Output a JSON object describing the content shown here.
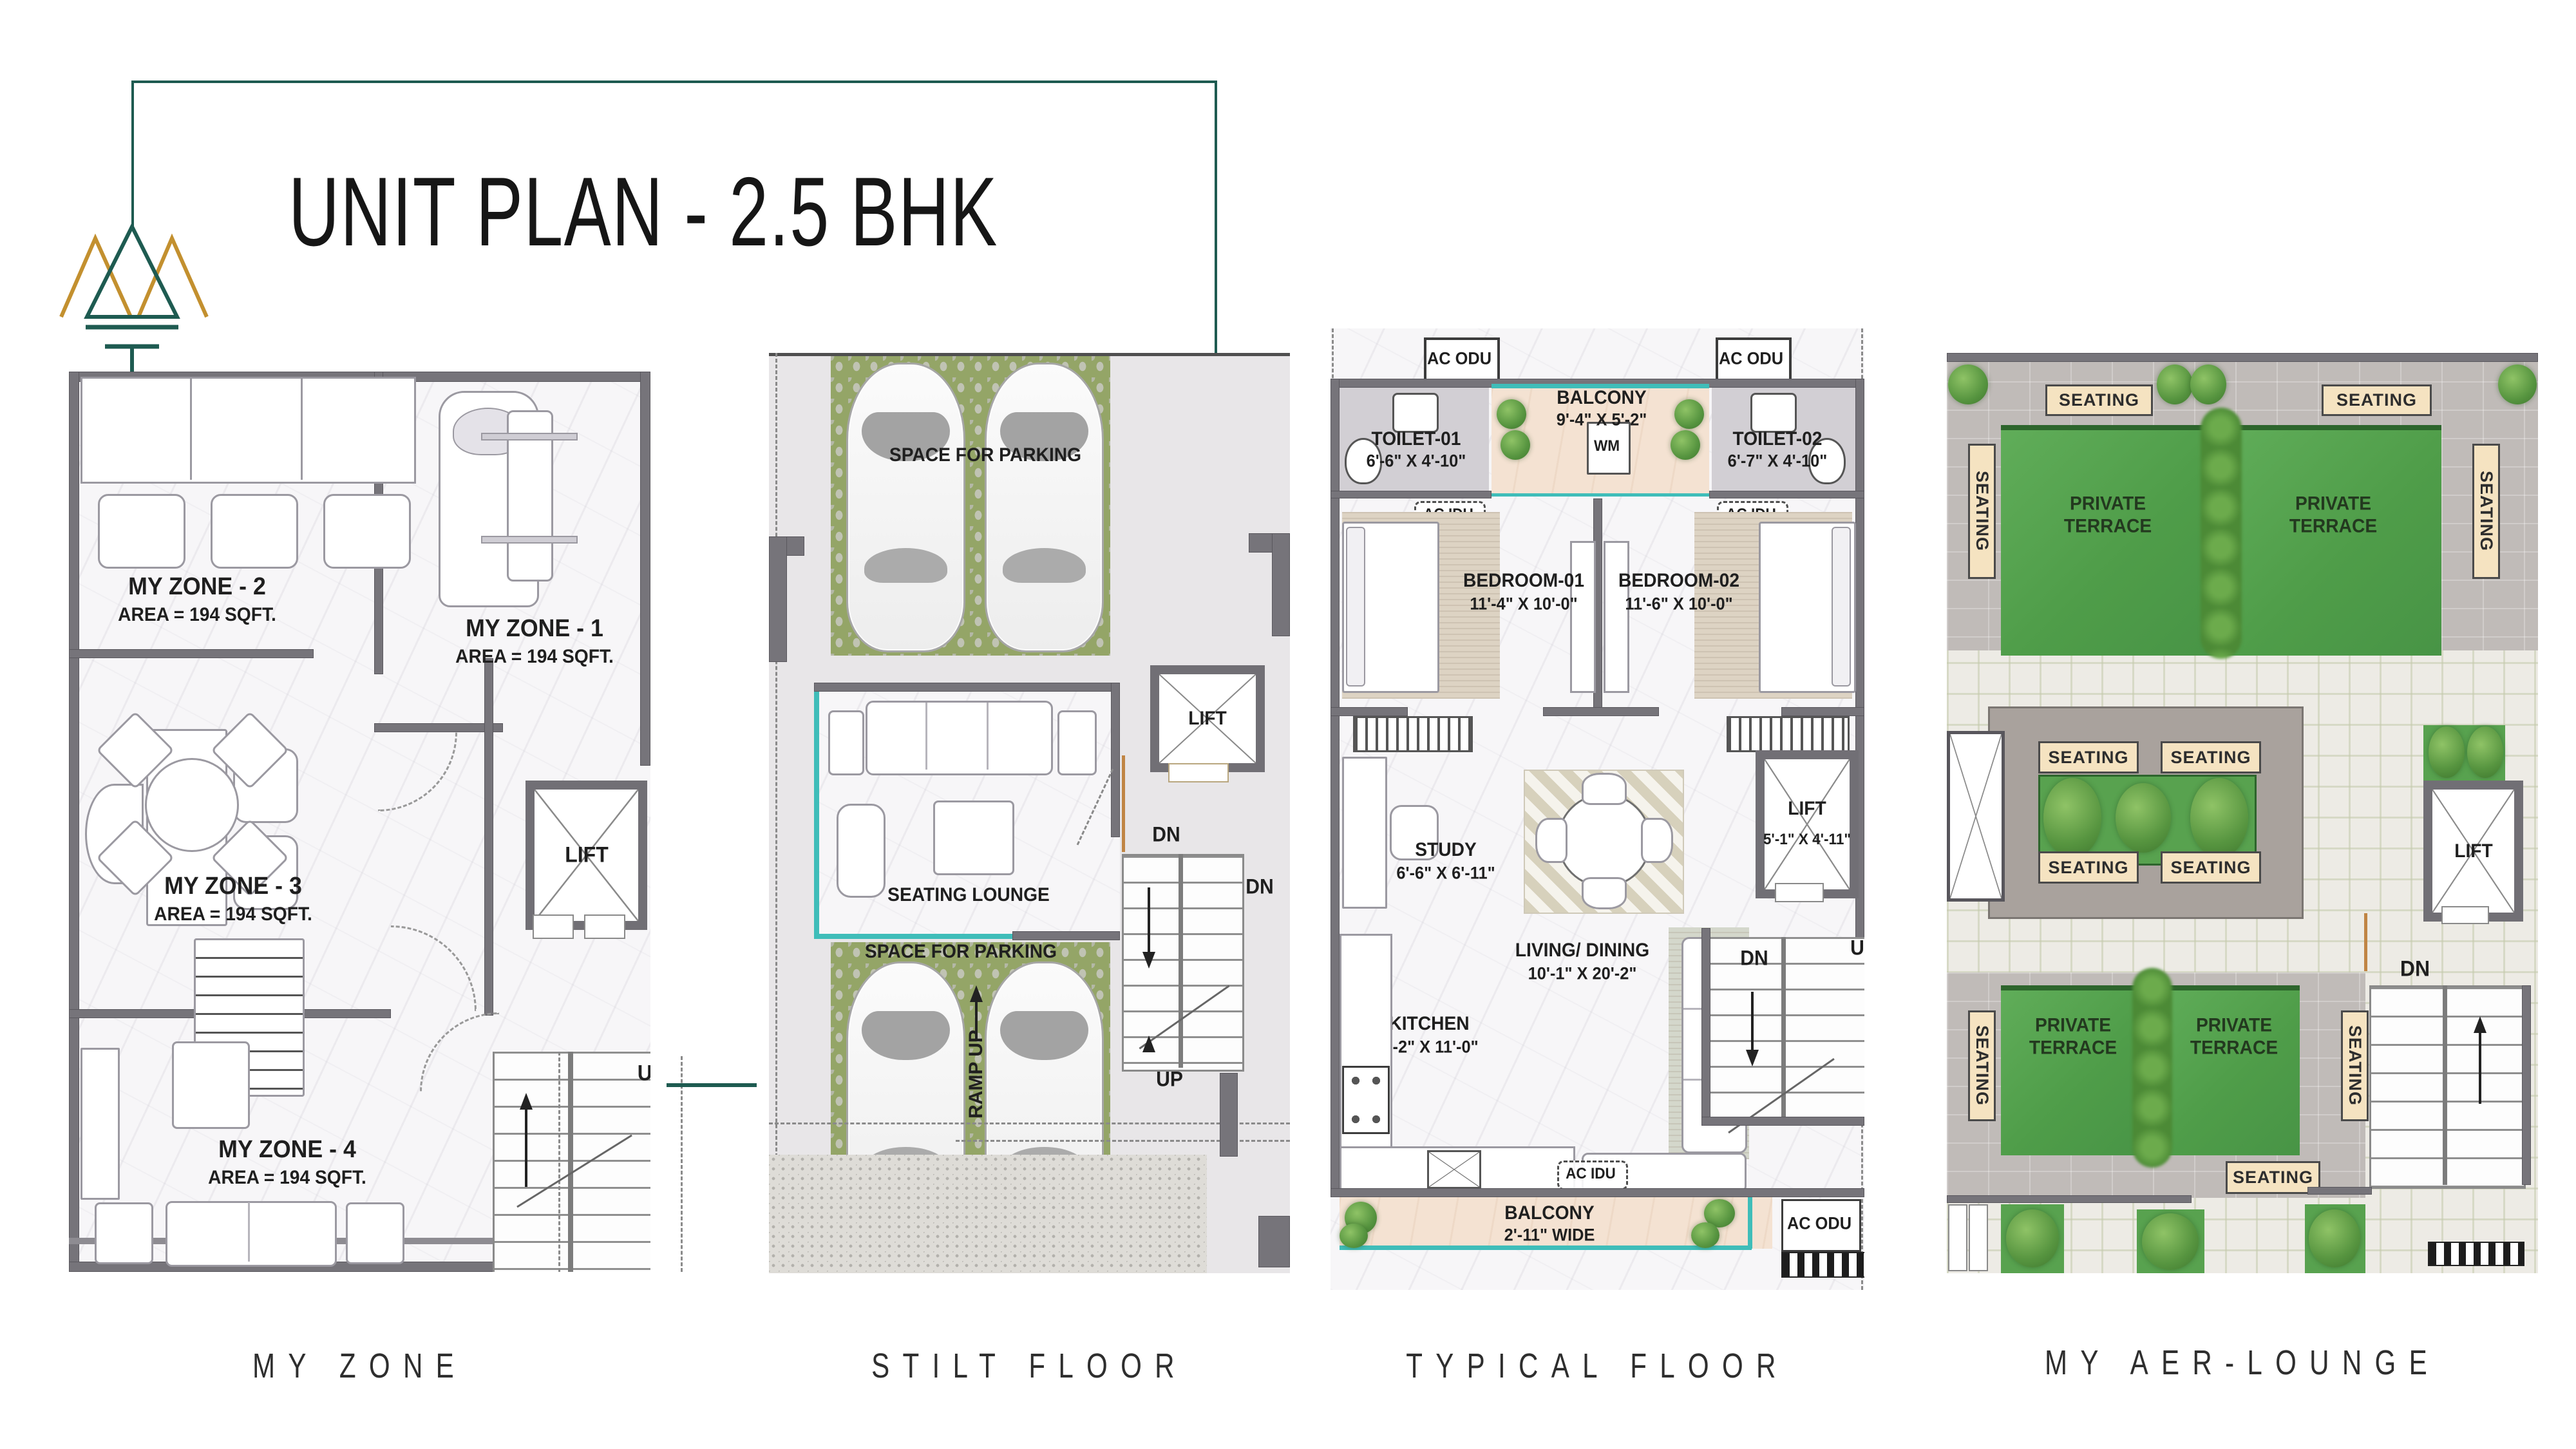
{
  "header": {
    "title": "UNIT PLAN - 2.5 BHK"
  },
  "colors": {
    "teal_accent": "#1e5b51",
    "gold_accent": "#c3902f",
    "railing_teal": "#3fbdb9",
    "terrace_green": "#55a24e",
    "bench_cream": "#f5e3c1"
  },
  "icons": {
    "logo": "triple-mountain-logo"
  },
  "plans": {
    "my_zone": {
      "caption": "MY ZONE",
      "zone1_name": "MY ZONE - 1",
      "zone1_area": "AREA = 194 SQFT.",
      "zone2_name": "MY ZONE - 2",
      "zone2_area": "AREA = 194 SQFT.",
      "zone3_name": "MY ZONE - 3",
      "zone3_area": "AREA = 194 SQFT.",
      "zone4_name": "MY ZONE - 4",
      "zone4_area": "AREA = 194 SQFT.",
      "lift": "LIFT",
      "up": "UP"
    },
    "stilt_floor": {
      "caption": "STILT FLOOR",
      "parking_top": "SPACE FOR PARKING",
      "parking_bottom": "SPACE FOR PARKING",
      "seating_lounge": "SEATING LOUNGE",
      "ramp_up": "RAMP UP",
      "lift": "LIFT",
      "dn": "DN",
      "dn_adjacent": "DN",
      "up": "UP"
    },
    "typical_floor": {
      "caption": "TYPICAL FLOOR",
      "ac_odu": "AC ODU",
      "ac_idu": "AC IDU",
      "wm": "WM",
      "toilet1_name": "TOILET-01",
      "toilet1_dims": "6'-6\" X 4'-10\"",
      "toilet2_name": "TOILET-02",
      "toilet2_dims": "6'-7\" X 4'-10\"",
      "balcony_top_name": "BALCONY",
      "balcony_top_dims": "9'-4\" X 5'-2\"",
      "bedroom1_name": "BEDROOM-01",
      "bedroom1_dims": "11'-4\" X 10'-0\"",
      "bedroom2_name": "BEDROOM-02",
      "bedroom2_dims": "11'-6\" X 10'-0\"",
      "study_name": "STUDY",
      "study_dims": "6'-6\" X 6'-11\"",
      "living_name": "LIVING/ DINING",
      "living_dims": "10'-1\" X 20'-2\"",
      "kitchen_name": "KITCHEN",
      "kitchen_dims": "6'-2\" X 11'-0\"",
      "lift_name": "LIFT",
      "lift_dims": "5'-1\" X 4'-11\"",
      "balcony_bottom_name": "BALCONY",
      "balcony_bottom_dims": "2'-11\" WIDE",
      "dn": "DN",
      "up": "UP"
    },
    "aer_lounge": {
      "caption": "MY AER-LOUNGE",
      "seating": "SEATING",
      "private_terrace": "PRIVATE\nTERRACE",
      "lift": "LIFT",
      "dn": "DN"
    }
  }
}
